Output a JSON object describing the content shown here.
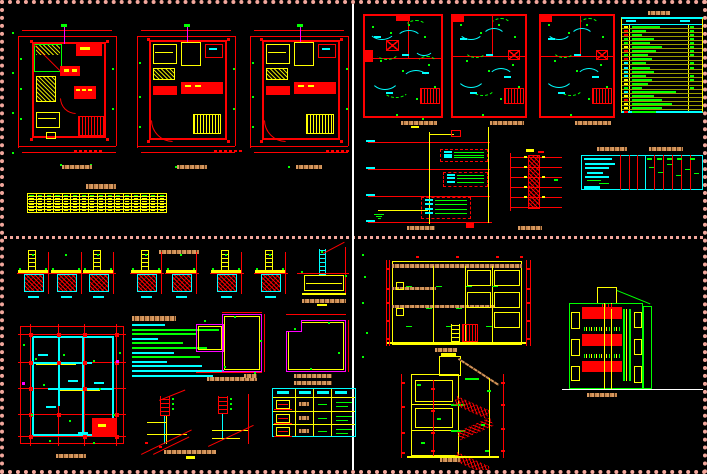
{
  "palette": {
    "red": "#ff0000",
    "yellow": "#ffff00",
    "green": "#00ff00",
    "cyan": "#00ffff",
    "magenta": "#ff00ff",
    "tan": "#d2955e",
    "white": "#ffffff",
    "sheet_border": "#f2a79c",
    "background": "#000000"
  },
  "legend": {
    "rows": [
      {
        "s": "yellow",
        "w": 28,
        "t": 1
      },
      {
        "s": "red",
        "w": 14,
        "t": 1
      },
      {
        "s": "red",
        "w": 10,
        "t": 1
      },
      {
        "s": "green",
        "w": 22,
        "t": 1
      },
      {
        "s": "green",
        "w": 18,
        "t": 1
      },
      {
        "s": "yellow",
        "w": 30,
        "t": 1
      },
      {
        "s": "red",
        "w": 24,
        "t": 1
      },
      {
        "s": "green",
        "w": 16,
        "t": 1
      },
      {
        "s": "red",
        "w": 20,
        "t": 0
      },
      {
        "s": "cyan",
        "w": 14,
        "t": 1
      },
      {
        "s": "cyan",
        "w": 18,
        "t": 1
      },
      {
        "s": "cyan",
        "w": 22,
        "t": 0
      },
      {
        "s": "cyan",
        "w": 14,
        "t": 1
      },
      {
        "s": "yellow",
        "w": 20,
        "t": 1
      },
      {
        "s": "yellow",
        "w": 16,
        "t": 0
      },
      {
        "s": "green",
        "w": 10,
        "t": 1
      },
      {
        "s": "cyan",
        "w": 44,
        "t": 0
      },
      {
        "s": "yellow",
        "w": 22,
        "t": 0
      },
      {
        "s": "red",
        "w": 30,
        "t": 0
      },
      {
        "s": "yellow",
        "w": 40,
        "t": 0
      },
      {
        "s": "yellow",
        "w": 30,
        "t": 0
      },
      {
        "s": "red",
        "w": 24,
        "t": 0
      }
    ]
  },
  "schedule": {
    "rows": 6,
    "cols": 16
  },
  "notes": {
    "lines": [
      {
        "c": "c",
        "w": 36
      },
      {
        "c": "g",
        "w": 95
      },
      {
        "c": "g",
        "w": 70
      },
      {
        "c": "c",
        "w": 28
      },
      {
        "c": "g",
        "w": 55
      },
      {
        "c": "g",
        "w": 82
      },
      {
        "c": "c",
        "w": 46
      },
      {
        "c": "g",
        "w": 74
      },
      {
        "c": "c",
        "w": 38
      },
      {
        "c": "c",
        "w": 76
      },
      {
        "c": "c",
        "w": 100
      },
      {
        "c": "c",
        "w": 88
      }
    ]
  },
  "footings": {
    "items": [
      {
        "x": 13,
        "lad": 1
      },
      {
        "x": 46,
        "lad": 0
      },
      {
        "x": 78,
        "lad": 1
      },
      {
        "x": 126,
        "lad": 1
      },
      {
        "x": 161,
        "lad": 0
      },
      {
        "x": 206,
        "lad": 1
      },
      {
        "x": 250,
        "lad": 1
      }
    ]
  },
  "riser": {
    "panels": [
      {
        "x": 78,
        "y": 25,
        "w": 48,
        "h": 13,
        "n": 3
      },
      {
        "x": 81,
        "y": 48,
        "w": 45,
        "h": 15,
        "n": 3
      },
      {
        "x": 59,
        "y": 73,
        "w": 50,
        "h": 22,
        "n": 4
      }
    ]
  },
  "lintel": {
    "rows": 3
  }
}
